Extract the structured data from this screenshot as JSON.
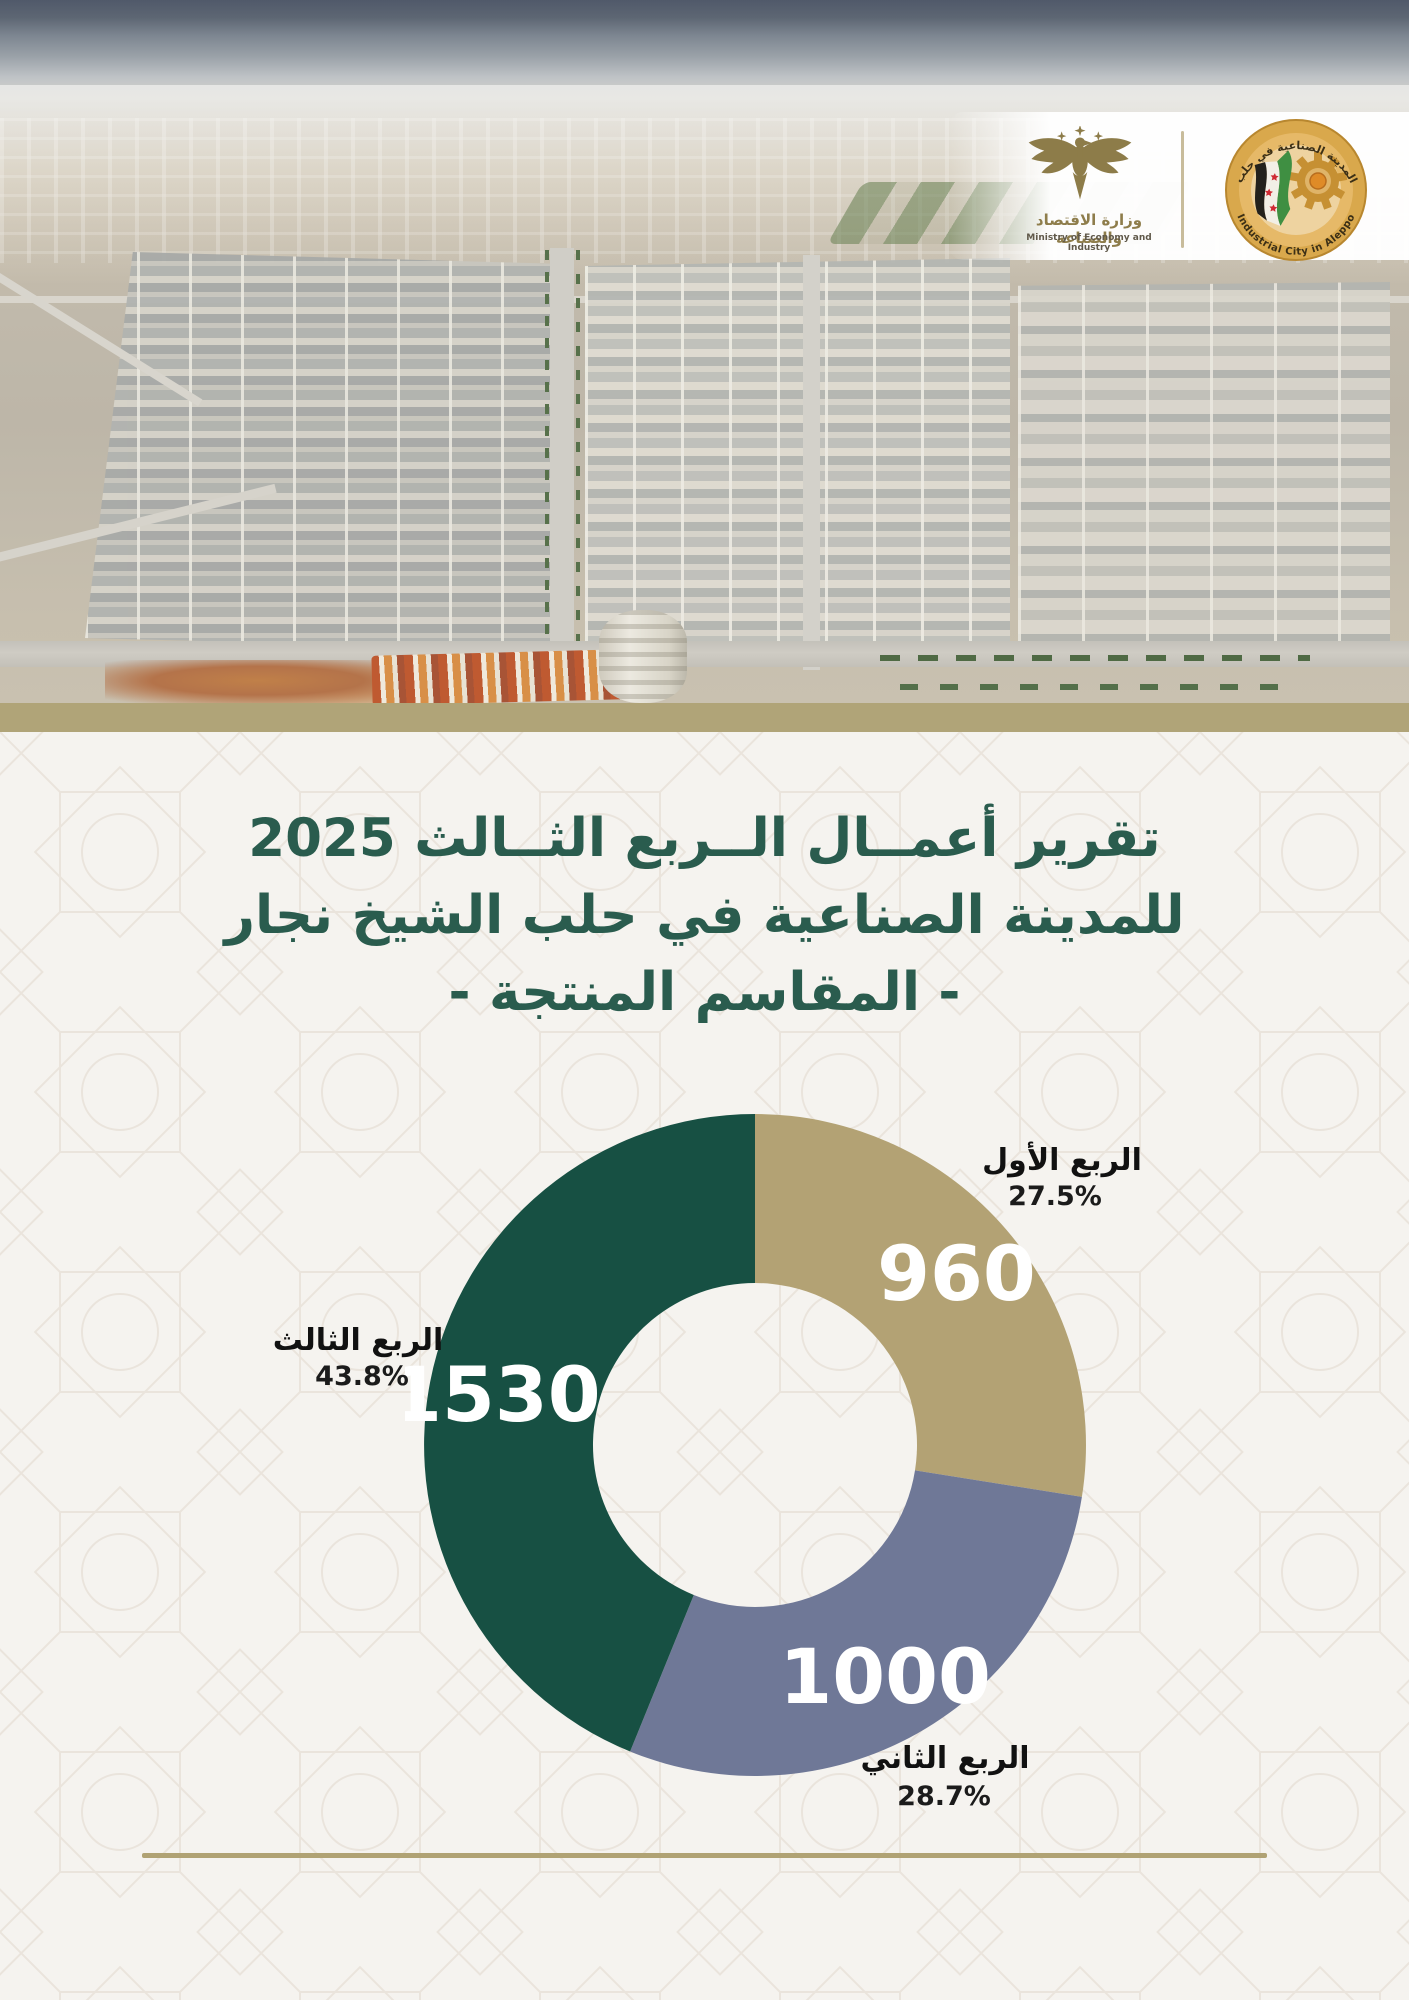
{
  "header": {
    "ministry": {
      "name_ar": "وزارة الاقتصاد والصناعة",
      "name_en": "Ministry of Economy and Industry"
    },
    "city": {
      "name_ar": "المدينة الصناعية في حلب",
      "name_en": "Industrial City in Aleppo"
    }
  },
  "title": {
    "line1": "تقرير أعمــال الــربع الثــالث 2025",
    "line2": "للمدينة الصناعية في حلب الشيخ نجار",
    "line3": "- المقاسم المنتجة -"
  },
  "colors": {
    "title_green": "#2a5c4e",
    "band_tan": "#b0a478",
    "rule_tan": "#b0a274",
    "q1_tan": "#b3a274",
    "q2_gray": "#6f7897",
    "q3_green": "#175043",
    "label_black": "#111111",
    "value_white": "#ffffff"
  },
  "chart_data": {
    "type": "pie",
    "subtype": "donut",
    "title": "المقاسم المنتجة - الربع الثالث 2025",
    "categories": [
      "الربع الأول",
      "الربع الثاني",
      "الربع الثالث"
    ],
    "series": [
      {
        "name": "الربع الأول",
        "value": 960,
        "pct": "27.5%",
        "color": "#b3a274"
      },
      {
        "name": "الربع الثاني",
        "value": 1000,
        "pct": "28.7%",
        "color": "#6f7897"
      },
      {
        "name": "الربع الثالث",
        "value": 1530,
        "pct": "43.8%",
        "color": "#175043"
      }
    ],
    "total": 3490,
    "start_angle_deg": 0,
    "clockwise": true,
    "inner_radius_ratio": 0.49,
    "value_labels_inside": true,
    "legend_position": "outside-callouts"
  }
}
